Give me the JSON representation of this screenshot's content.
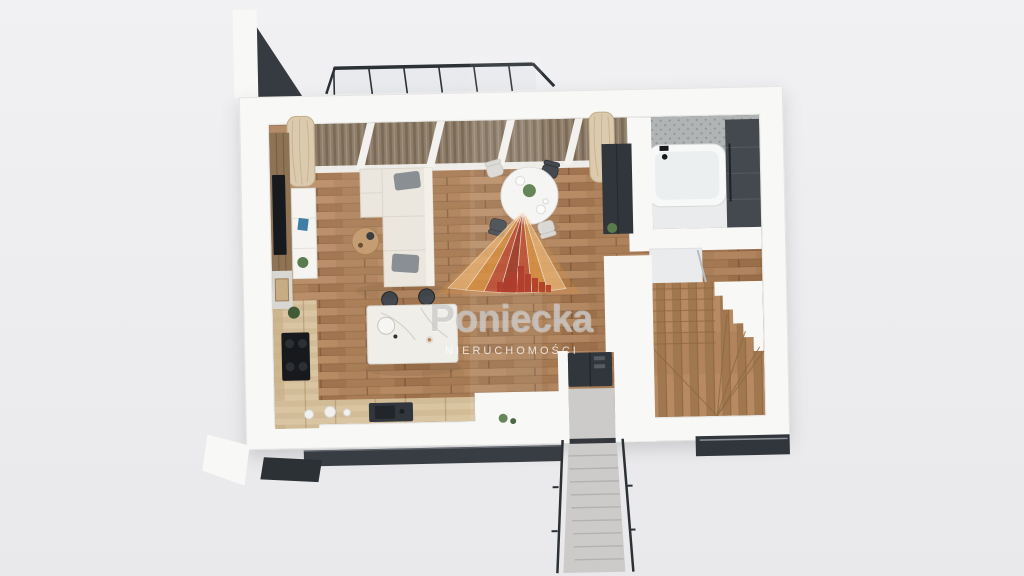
{
  "scene": {
    "type": "3d-floorplan-render",
    "view": "top-down tilted",
    "description": "Photorealistic 3D top view of a studio apartment ground floor with terrace, living room, dining area, kitchen, bathroom and winder staircase; real-estate watermark in the center"
  },
  "watermark": {
    "brand": "Poniecka",
    "subtitle": "NIERUCHOMOŚCI",
    "logo": "fan-rays-over-red-skyline"
  },
  "rooms": [
    {
      "name": "terrace",
      "items": [
        "black-railing",
        "brown-drapes",
        "beige-curtains",
        "white-mullions"
      ]
    },
    {
      "name": "living-room",
      "items": [
        "l-shaped-cream-sofa",
        "gray-pillows",
        "round-coffee-table",
        "tv",
        "wood-media-wall",
        "white-sideboard",
        "plants"
      ]
    },
    {
      "name": "dining-area",
      "items": [
        "round-white-table",
        "four-chairs",
        "plant-centerpiece",
        "plates"
      ]
    },
    {
      "name": "kitchen",
      "items": [
        "l-shaped-light-wood-counter",
        "induction-cooktop",
        "dark-sink",
        "marble-island",
        "two-bar-stools"
      ]
    },
    {
      "name": "bathroom",
      "items": [
        "white-bathtub",
        "black-faucet",
        "hex-tile-wall",
        "dark-storage-cabinet",
        "marble-floor",
        "glass-door"
      ]
    },
    {
      "name": "hall",
      "items": [
        "dark-wardrobe",
        "fridge",
        "white-partition-walls"
      ]
    },
    {
      "name": "staircase",
      "items": [
        "wooden-winder-stairs"
      ]
    },
    {
      "name": "entry",
      "items": [
        "exterior-concrete-steps",
        "black-handrails",
        "lower-floor-glazing"
      ]
    }
  ],
  "colors": {
    "bg_top": "#f1f1f3",
    "bg_bottom": "#e9e9ec",
    "wall_white": "#f8f8f6",
    "wall_stroke": "#e6e5e2",
    "floor_wood": "#b3875f",
    "floor_wood_dark": "#a2754e",
    "floor_wood_light": "#c0946b",
    "kitchen_counter": "#d9c5a2",
    "kitchen_counter_dark": "#c4ab82",
    "island_marble": "#f0eee9",
    "sofa_cream": "#ebe7de",
    "sofa_back": "#f3f0e9",
    "pillow_gray": "#8a8f94",
    "dark_charcoal": "#31363c",
    "dark_cabinet": "#44494f",
    "tile_gray": "#b0b4b4",
    "tile_dot": "#8f9495",
    "marble_floor": "#eaebed",
    "curtain_beige": "#dbcaae",
    "curtain_line": "#c2ad8a",
    "drapes_brown": "#8e7d69",
    "drapes_brown_dark": "#7a6955",
    "accent_wood": "#8e7455",
    "tv_black": "#17191d",
    "stairs_wood": "#b1845b",
    "stairs_wood_dark": "#8d683f",
    "concrete": "#cccbc9",
    "concrete_dark": "#b3b2b0",
    "railing_black": "#2c3136",
    "glass_tint": "#cdd6da",
    "metal_line": "#8d9298",
    "logo_orange": "#d98f3f",
    "logo_orange_light": "#e7b173",
    "logo_red": "#bf4a32",
    "logo_red_dark": "#9d3024",
    "logo_skyline": "#b23427",
    "wm_text": "#c6c6c6",
    "wm_sub": "#ffffff",
    "plant_green": "#5a7c4c",
    "plant_green_dark": "#3f5c36",
    "accent_blue": "#3f7fa6"
  }
}
